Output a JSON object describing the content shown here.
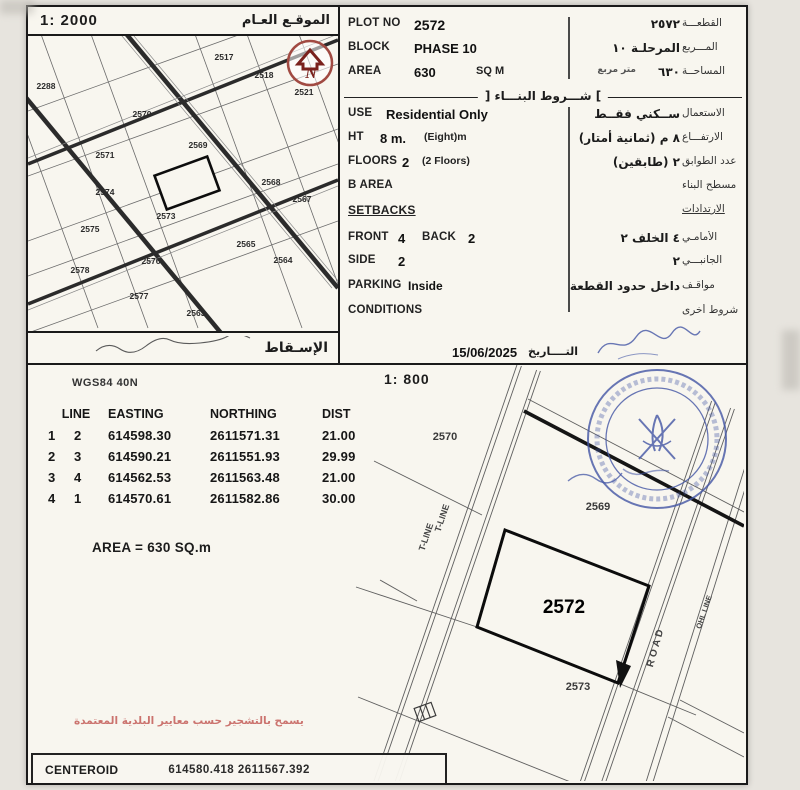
{
  "colors": {
    "ink": "#1a1a1a",
    "stamp_blue": "#4356a5",
    "north_red": "#8a2420",
    "note_red": "#c0534f"
  },
  "overview": {
    "scale": "1: 2000",
    "title_ar": "الموقـع العـام",
    "footer_ar": "الإسـقاط",
    "main_plot": "2572",
    "plot_labels": [
      {
        "t": "2288",
        "x": 18,
        "y": 50
      },
      {
        "t": "2517",
        "x": 196,
        "y": 21
      },
      {
        "t": "2518",
        "x": 236,
        "y": 39
      },
      {
        "t": "2521",
        "x": 276,
        "y": 56
      },
      {
        "t": "2570",
        "x": 114,
        "y": 78
      },
      {
        "t": "2569",
        "x": 170,
        "y": 109
      },
      {
        "t": "2571",
        "x": 77,
        "y": 119
      },
      {
        "t": "2568",
        "x": 243,
        "y": 146
      },
      {
        "t": "2567",
        "x": 274,
        "y": 163
      },
      {
        "t": "2574",
        "x": 77,
        "y": 156
      },
      {
        "t": "2573",
        "x": 138,
        "y": 180
      },
      {
        "t": "2575",
        "x": 62,
        "y": 193
      },
      {
        "t": "2565",
        "x": 218,
        "y": 208
      },
      {
        "t": "2578",
        "x": 52,
        "y": 234
      },
      {
        "t": "2576",
        "x": 123,
        "y": 225
      },
      {
        "t": "2564",
        "x": 255,
        "y": 224
      },
      {
        "t": "2577",
        "x": 111,
        "y": 260
      },
      {
        "t": "2563",
        "x": 168,
        "y": 277
      }
    ]
  },
  "info": {
    "plot_no": {
      "label": "PLOT NO",
      "value": "2572",
      "ar_value": "٢٥٧٢",
      "ar_label": "القطعـــة"
    },
    "block": {
      "label": "BLOCK",
      "value": "PHASE 10",
      "ar_value": "المرحلـة ١٠",
      "ar_label": "المـــربع"
    },
    "area": {
      "label": "AREA",
      "value": "630",
      "unit": "SQ M",
      "ar_value": "٦٣٠",
      "ar_note": "متر مربع",
      "ar_label": "المساحــة"
    },
    "section_title_ar": "] شـــروط البنـــاء [",
    "use": {
      "label": "USE",
      "value": "Residential Only",
      "ar_value": "ســكني فقــط",
      "ar_label": "الاستعمال"
    },
    "ht": {
      "label": "HT",
      "value": "8 m.",
      "note": "(Eight)m",
      "ar_value": "٨   م (ثمانية أمتار)",
      "ar_label": "الارتفـــاع"
    },
    "floors": {
      "label": "FLOORS",
      "value": "2",
      "note": "(2 Floors)",
      "ar_value": "٢   (طابقين)",
      "ar_label": "عدد الطوابق"
    },
    "b_area": {
      "label": "B AREA",
      "ar_label": "مسطح البناء"
    },
    "setbacks": {
      "label": "SETBACKS",
      "ar_label": "الارتدادات"
    },
    "front": {
      "label": "FRONT",
      "value": "4",
      "label2": "BACK",
      "value2": "2",
      "ar_value": "٤   الخلف   ٢",
      "ar_label": "الأمامـي"
    },
    "side": {
      "label": "SIDE",
      "value": "2",
      "ar_value": "٢",
      "ar_label": "الجانبـــي"
    },
    "parking": {
      "label": "PARKING",
      "value": "Inside",
      "ar_value": "داخل حدود القطعة",
      "ar_label": "مواقـف"
    },
    "conditions": {
      "label": "CONDITIONS",
      "ar_label": "شروط أخرى"
    },
    "date": {
      "value": "15/06/2025",
      "ar_label": "التــــاريخ"
    }
  },
  "survey": {
    "scale": "1: 800",
    "datum": "WGS84 40N",
    "table": {
      "headers": [
        "LINE",
        "EASTING",
        "NORTHING",
        "DIST"
      ],
      "rows": [
        [
          "1",
          "2",
          "614598.30",
          "2611571.31",
          "21.00"
        ],
        [
          "2",
          "3",
          "614590.21",
          "2611551.93",
          "29.99"
        ],
        [
          "3",
          "4",
          "614562.53",
          "2611563.48",
          "21.00"
        ],
        [
          "4",
          "1",
          "614570.61",
          "2611582.86",
          "30.00"
        ]
      ],
      "area_label": "AREA = 630  SQ.m"
    },
    "map_labels": [
      {
        "t": "2570",
        "x": 417,
        "y": 72
      },
      {
        "t": "2569",
        "x": 570,
        "y": 142
      },
      {
        "t": "2572",
        "x": 536,
        "y": 243,
        "big": 1
      },
      {
        "t": "2573",
        "x": 550,
        "y": 322
      }
    ],
    "road_labels": [
      {
        "t": "T-LINE",
        "x": 398,
        "y": 172,
        "r": -71,
        "s": 9
      },
      {
        "t": "T-LINE",
        "x": 414,
        "y": 153,
        "r": -71,
        "s": 9
      },
      {
        "t": "ROAD",
        "x": 628,
        "y": 282,
        "r": -74,
        "s": 10,
        "ls": 3
      },
      {
        "t": "OHL LINE",
        "x": 676,
        "y": 247,
        "r": -71,
        "s": 7.5
      }
    ],
    "note_ar": "يسمح بالتشجير حسب معايير البلدية المعتمدة",
    "centeroid": {
      "label": "CENTEROID",
      "value": "614580.418  2611567.392"
    }
  }
}
